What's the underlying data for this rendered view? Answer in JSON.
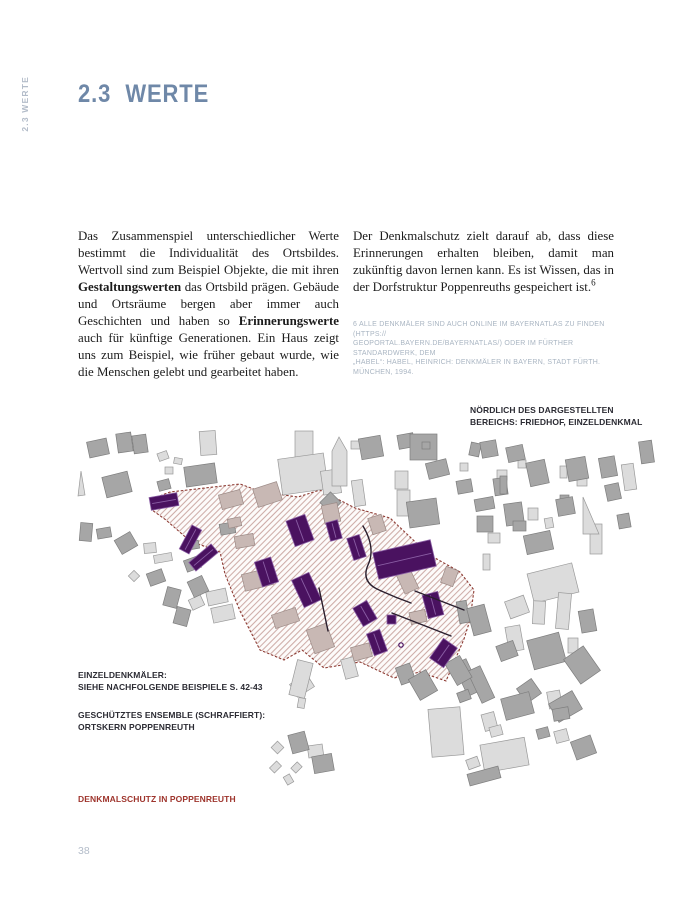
{
  "page": {
    "number": "38"
  },
  "sidebar": {
    "vertical_label": "2.3 WERTE"
  },
  "heading": {
    "number": "2.3",
    "title": "WERTE"
  },
  "columns": {
    "left_segments": [
      {
        "t": "Das Zusammenspiel unterschiedlicher Werte bestimmt die Individualität des Ortsbildes. Wertvoll sind zum Beispiel Objekte, die mit ihren ",
        "b": false
      },
      {
        "t": "Gestaltungswerten",
        "b": true
      },
      {
        "t": " das Ortsbild prägen. Gebäude und Ortsräume bergen aber immer auch Geschichten und haben so ",
        "b": false
      },
      {
        "t": "Erinnerungswerte",
        "b": true
      },
      {
        "t": " auch für künftige Generationen. Ein Haus zeigt uns zum Beispiel, wie früher gebaut wurde, wie die Menschen gelebt und gearbeitet haben.",
        "b": false
      }
    ],
    "right_segments": [
      {
        "t": "Der Denkmalschutz zielt darauf ab, dass diese Erinnerungen erhalten bleiben, damit man zukünftig davon lernen kann. Es ist Wissen, das in der Dorfstruktur Poppenreuths gespeichert ist.",
        "b": false
      },
      {
        "t": "6",
        "sup": true
      }
    ]
  },
  "footnote": {
    "lines": [
      "6 ALLE DENKMÄLER SIND AUCH ONLINE IM BAYERNATLAS ZU FINDEN (HTTPS://",
      "GEOPORTAL.BAYERN.DE/BAYERNATLAS/) ODER IM FÜRTHER STANDARDWERK, DEM",
      "„HABEL“: HABEL, HEINRICH: DENKMÄLER IN BAYERN, STADT FÜRTH. MÜNCHEN, 1994."
    ]
  },
  "map": {
    "note_north": {
      "line1": "NÖRDLICH DES DARGESTELLTEN",
      "line2": "BEREICHS: FRIEDHOF, EINZELDENKMAL"
    },
    "legend_monuments": {
      "line1": "EINZELDENKMÄLER:",
      "line2": "SIEHE NACHFOLGENDE BEISPIELE S. 42-43"
    },
    "legend_ensemble": {
      "line1": "GESCHÜTZTES ENSEMBLE (SCHRAFFIERT):",
      "line2": "ORTSKERN POPPENREUTH"
    },
    "caption": "DENKMALSCHUTZ IN POPPENREUTH",
    "geometry": {
      "ensemble_polygon": "82,75 100,68 170,60 192,68 228,73 250,66 285,84 320,94 358,130 390,148 404,166 400,196 394,215 376,257 350,248 324,254 290,238 254,244 232,226 214,236 190,226 170,187 155,150 150,128 120,117 96,96 82,86",
      "monuments": [
        [
          80,
          71,
          28,
          13,
          -10
        ],
        [
          115,
          102,
          11,
          27,
          28
        ],
        [
          119,
          128,
          29,
          11,
          -40
        ],
        [
          220,
          93,
          20,
          27,
          -20
        ],
        [
          258,
          97,
          12,
          19,
          -15
        ],
        [
          280,
          112,
          13,
          23,
          -18
        ],
        [
          188,
          135,
          17,
          26,
          -18
        ],
        [
          227,
          151,
          19,
          30,
          -25
        ],
        [
          305,
          122,
          59,
          27,
          -13
        ],
        [
          287,
          179,
          16,
          21,
          -30
        ],
        [
          355,
          169,
          16,
          24,
          -15
        ],
        [
          300,
          207,
          14,
          23,
          -20
        ],
        [
          365,
          217,
          17,
          24,
          35
        ],
        [
          317,
          191,
          9,
          9,
          0
        ]
      ],
      "monument_circle": [
        331,
        221,
        2.2
      ],
      "ensemble_buildings": [
        [
          150,
          68,
          22,
          15,
          -15
        ],
        [
          185,
          61,
          25,
          19,
          -18
        ],
        [
          253,
          80,
          16,
          19,
          -12
        ],
        [
          300,
          92,
          14,
          17,
          -18
        ],
        [
          165,
          111,
          19,
          12,
          -10
        ],
        [
          173,
          147,
          29,
          17,
          -14
        ],
        [
          203,
          187,
          25,
          14,
          -18
        ],
        [
          240,
          202,
          21,
          25,
          -20
        ],
        [
          282,
          221,
          19,
          14,
          -15
        ],
        [
          330,
          147,
          15,
          21,
          -25
        ],
        [
          340,
          187,
          16,
          12,
          -12
        ],
        [
          373,
          144,
          13,
          17,
          20
        ],
        [
          158,
          94,
          13,
          9,
          -12
        ]
      ],
      "buildings_medium": [
        [
          18,
          16,
          20,
          16,
          -12
        ],
        [
          47,
          9,
          15,
          19,
          -8
        ],
        [
          63,
          11,
          14,
          18,
          -8
        ],
        [
          34,
          50,
          26,
          21,
          -14
        ],
        [
          88,
          56,
          12,
          10,
          -15
        ],
        [
          328,
          10,
          16,
          14,
          -10
        ],
        [
          290,
          13,
          22,
          21,
          -10
        ],
        [
          340,
          10,
          27,
          26,
          0
        ],
        [
          357,
          37,
          21,
          16,
          -14
        ],
        [
          387,
          56,
          15,
          13,
          -10
        ],
        [
          400,
          19,
          10,
          13,
          12
        ],
        [
          411,
          17,
          16,
          16,
          -10
        ],
        [
          437,
          22,
          17,
          15,
          -12
        ],
        [
          458,
          37,
          19,
          24,
          -12
        ],
        [
          424,
          54,
          13,
          17,
          -8
        ],
        [
          497,
          34,
          20,
          22,
          -10
        ],
        [
          490,
          71,
          9,
          14,
          0
        ],
        [
          487,
          74,
          17,
          17,
          -10
        ],
        [
          435,
          79,
          18,
          22,
          -8
        ],
        [
          455,
          109,
          27,
          19,
          -12
        ],
        [
          430,
          52,
          7,
          18,
          0
        ],
        [
          115,
          41,
          31,
          20,
          -8
        ],
        [
          253,
          71,
          15,
          15,
          45
        ],
        [
          338,
          76,
          30,
          26,
          -8
        ],
        [
          405,
          74,
          19,
          12,
          -10
        ],
        [
          407,
          92,
          16,
          16,
          0
        ],
        [
          443,
          97,
          13,
          10,
          0
        ],
        [
          510,
          186,
          15,
          22,
          -10
        ],
        [
          460,
          212,
          33,
          30,
          -15
        ],
        [
          500,
          226,
          24,
          30,
          -35
        ],
        [
          450,
          258,
          18,
          18,
          -35
        ],
        [
          482,
          272,
          27,
          21,
          -30
        ],
        [
          388,
          177,
          10,
          22,
          -10
        ],
        [
          400,
          182,
          18,
          28,
          -15
        ],
        [
          428,
          219,
          18,
          16,
          -20
        ],
        [
          390,
          236,
          14,
          35,
          -25
        ],
        [
          404,
          243,
          14,
          35,
          -25
        ],
        [
          388,
          267,
          12,
          10,
          -20
        ],
        [
          433,
          271,
          29,
          22,
          -15
        ],
        [
          483,
          284,
          16,
          12,
          -10
        ],
        [
          467,
          304,
          12,
          10,
          -15
        ],
        [
          503,
          314,
          21,
          19,
          -20
        ],
        [
          398,
          346,
          32,
          12,
          -15
        ],
        [
          328,
          241,
          15,
          18,
          -20
        ],
        [
          343,
          249,
          20,
          24,
          -30
        ],
        [
          380,
          234,
          17,
          25,
          -30
        ],
        [
          243,
          331,
          20,
          17,
          -10
        ],
        [
          220,
          309,
          17,
          19,
          -15
        ],
        [
          10,
          99,
          12,
          18,
          5
        ],
        [
          27,
          104,
          14,
          10,
          -10
        ],
        [
          47,
          111,
          18,
          16,
          -30
        ],
        [
          78,
          147,
          16,
          13,
          -20
        ],
        [
          95,
          164,
          14,
          19,
          15
        ],
        [
          105,
          184,
          14,
          17,
          15
        ],
        [
          115,
          134,
          15,
          12,
          -20
        ],
        [
          120,
          154,
          16,
          17,
          -25
        ],
        [
          150,
          99,
          15,
          11,
          -10
        ],
        [
          119,
          117,
          10,
          8,
          -10
        ],
        [
          352,
          18,
          8,
          7,
          0
        ],
        [
          530,
          33,
          16,
          20,
          -10
        ],
        [
          536,
          60,
          14,
          16,
          -12
        ],
        [
          570,
          17,
          13,
          22,
          -8
        ],
        [
          548,
          90,
          12,
          14,
          -10
        ]
      ],
      "buildings_light": [
        [
          88,
          28,
          10,
          8,
          -20
        ],
        [
          95,
          43,
          8,
          7,
          0
        ],
        [
          104,
          34,
          8,
          6,
          10
        ],
        [
          130,
          7,
          16,
          24,
          -4
        ],
        [
          225,
          7,
          18,
          26,
          0
        ],
        [
          281,
          17,
          10,
          8,
          0
        ],
        [
          210,
          32,
          46,
          36,
          -8
        ],
        [
          252,
          46,
          18,
          24,
          -8
        ],
        [
          283,
          56,
          11,
          26,
          -8
        ],
        [
          325,
          47,
          13,
          18,
          0
        ],
        [
          327,
          66,
          13,
          26,
          0
        ],
        [
          390,
          39,
          8,
          8,
          0
        ],
        [
          427,
          46,
          10,
          10,
          0
        ],
        [
          448,
          36,
          8,
          8,
          0
        ],
        [
          490,
          42,
          7,
          12,
          0
        ],
        [
          458,
          84,
          10,
          12,
          0
        ],
        [
          475,
          94,
          8,
          10,
          -10
        ],
        [
          507,
          52,
          10,
          10,
          0
        ],
        [
          418,
          109,
          12,
          10,
          0
        ],
        [
          413,
          130,
          7,
          16,
          0
        ],
        [
          460,
          144,
          46,
          30,
          -14
        ],
        [
          463,
          177,
          12,
          23,
          3
        ],
        [
          487,
          169,
          13,
          36,
          5
        ],
        [
          498,
          214,
          10,
          15,
          0
        ],
        [
          437,
          202,
          15,
          25,
          -10
        ],
        [
          437,
          174,
          20,
          18,
          -20
        ],
        [
          478,
          267,
          13,
          17,
          -10
        ],
        [
          485,
          306,
          13,
          12,
          -15
        ],
        [
          360,
          284,
          32,
          48,
          -5
        ],
        [
          413,
          289,
          13,
          17,
          -15
        ],
        [
          420,
          302,
          12,
          10,
          -15
        ],
        [
          412,
          317,
          45,
          28,
          -10
        ],
        [
          397,
          334,
          12,
          10,
          -20
        ],
        [
          222,
          254,
          20,
          15,
          -32
        ],
        [
          223,
          237,
          16,
          36,
          14
        ],
        [
          228,
          274,
          7,
          10,
          10
        ],
        [
          273,
          234,
          13,
          20,
          -15
        ],
        [
          203,
          319,
          9,
          9,
          45
        ],
        [
          238,
          321,
          15,
          12,
          -8
        ],
        [
          202,
          338,
          7,
          10,
          45
        ],
        [
          223,
          339,
          7,
          9,
          45
        ],
        [
          215,
          351,
          7,
          9,
          -30
        ],
        [
          60,
          148,
          8,
          8,
          45
        ],
        [
          74,
          119,
          12,
          10,
          -5
        ],
        [
          84,
          130,
          18,
          8,
          -10
        ],
        [
          137,
          166,
          20,
          14,
          -12
        ],
        [
          142,
          182,
          22,
          15,
          -12
        ],
        [
          120,
          173,
          13,
          11,
          -25
        ],
        [
          553,
          40,
          12,
          26,
          -8
        ],
        [
          520,
          100,
          12,
          30,
          0
        ]
      ],
      "polygons_light": [
        "262,27 269,13 277,27 277,62 262,62",
        "513,110 513,73 529,110",
        "8,72 11,47 15,71"
      ],
      "streets": [
        "M293,102 Q306,124 298,141 Q291,157 307,165 Q324,173 341,179",
        "M345,167 L394,186",
        "M322,189 L381,212",
        "M249,164 L258,207"
      ]
    }
  },
  "colors": {
    "c-heading": "#6f88a8",
    "c-muted": "#b3bcc9",
    "c-footnote": "#a9b5c2",
    "c-label": "#2b2b33",
    "c-caption": "#9e342c",
    "c-denkmal": "#4a1260",
    "c-denkmal-edge": "#8a5ea4",
    "c-hatch": "#c59e99",
    "c-boundary": "#8d3b33",
    "c-ens-fill": "#fdfbfa",
    "c-bldg-light": "#dcdcdc",
    "c-bldg-light-edge": "#999999",
    "c-bldg-med": "#a6a6a6",
    "c-bldg-med-edge": "#7e7e7e",
    "c-beige": "#c8b8b4",
    "c-beige-edge": "#9c8a86",
    "c-street": "#2a1f2e"
  }
}
